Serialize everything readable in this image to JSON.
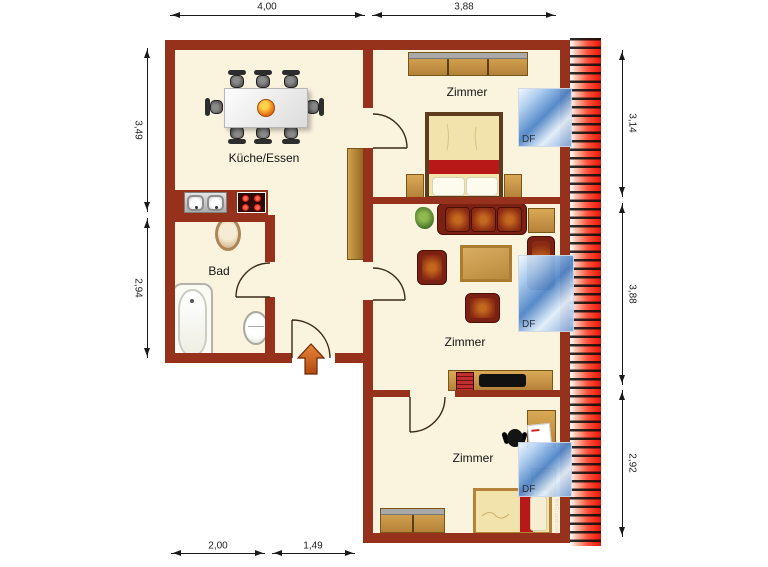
{
  "rooms": {
    "kitchen": "Küche/Essen",
    "bath": "Bad",
    "bedroom_top": "Zimmer",
    "living": "Zimmer",
    "bedroom_bottom": "Zimmer"
  },
  "dims": {
    "top": [
      "4,00",
      "3,88"
    ],
    "left": [
      "3,49",
      "2,94"
    ],
    "right": [
      "3,14",
      "3,88",
      "2,92"
    ],
    "bottom": [
      "2,00",
      "1,49"
    ]
  },
  "skylights": [
    "DF",
    "DF",
    "DF"
  ],
  "watermark": "MbGrundrisse",
  "colors": {
    "wall": "#96311b",
    "floor": "#faf3de",
    "roof_edge_red": "#ec1408",
    "skylight_blue": "#4f85c8",
    "wood": "#c08a3e",
    "upholstery": "#7a2113",
    "bed_stripe_red": "#b81818",
    "entrance_arrow_orange": "#d2691e"
  }
}
